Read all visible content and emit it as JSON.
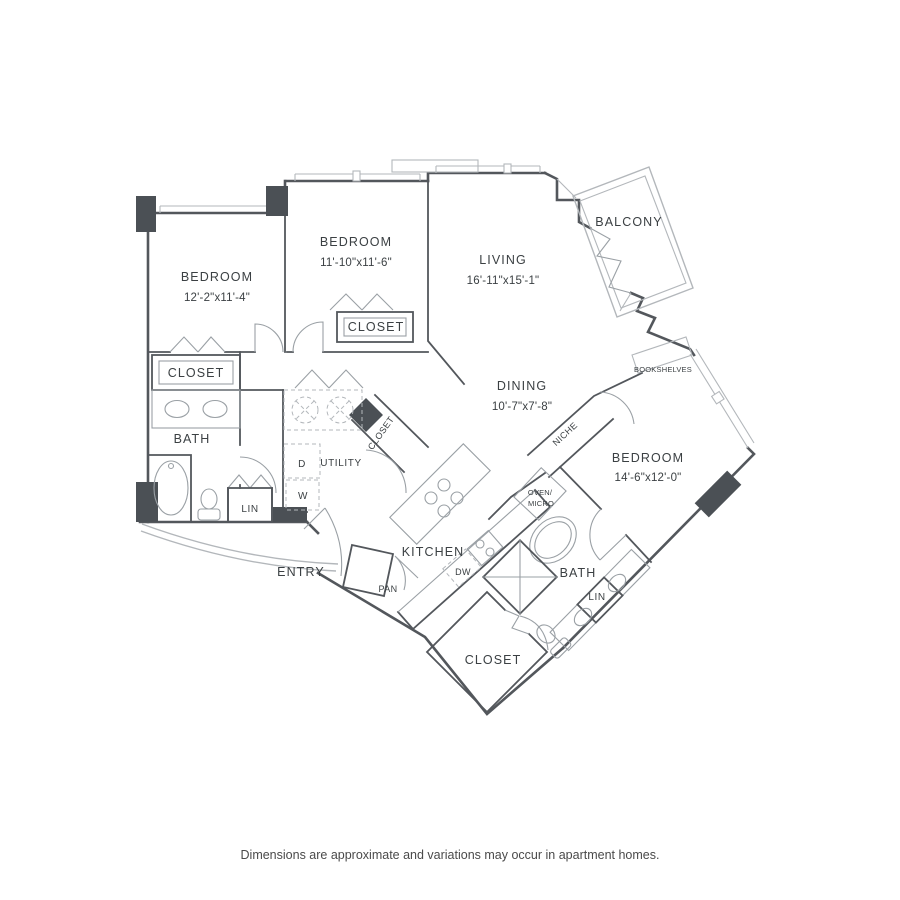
{
  "colors": {
    "wall": "#53575c",
    "thin": "#9aa0a5",
    "light": "#b3b7bb",
    "column": "#4b5055",
    "text": "#3b4043",
    "footer": "#4a4a4a"
  },
  "plan": {
    "rooms": {
      "bedroom1": {
        "name": "BEDROOM",
        "dims": "12'-2\"x11'-4\""
      },
      "bedroom2": {
        "name": "BEDROOM",
        "dims": "11'-10\"x11'-6\""
      },
      "bedroom3": {
        "name": "BEDROOM",
        "dims": "14'-6\"x12'-0\""
      },
      "living": {
        "name": "LIVING",
        "dims": "16'-11\"x15'-1\""
      },
      "dining": {
        "name": "DINING",
        "dims": "10'-7\"x7'-8\""
      },
      "balcony": {
        "name": "BALCONY"
      },
      "kitchen": {
        "name": "KITCHEN"
      },
      "entry": {
        "name": "ENTRY"
      },
      "bath1": {
        "name": "BATH"
      },
      "bath2": {
        "name": "BATH"
      },
      "closet1": {
        "name": "CLOSET"
      },
      "closet2": {
        "name": "CLOSET"
      },
      "closet3": {
        "name": "CLOSET"
      },
      "utilityCloset": {
        "name": "CLOSET"
      },
      "utility": {
        "name": "UTILITY"
      },
      "lin1": {
        "name": "LIN"
      },
      "lin2": {
        "name": "LIN"
      },
      "pantry": {
        "name": "PAN"
      },
      "niche": {
        "name": "NICHE"
      },
      "bookshelves": {
        "name": "BOOKSHELVES"
      },
      "dishwasher": {
        "name": "DW"
      },
      "ovenMicro": {
        "line1": "OVEN/",
        "line2": "MICRO"
      },
      "dryer": {
        "name": "D"
      },
      "washer": {
        "name": "W"
      }
    },
    "footer": "Dimensions are approximate and variations may occur in apartment homes."
  }
}
